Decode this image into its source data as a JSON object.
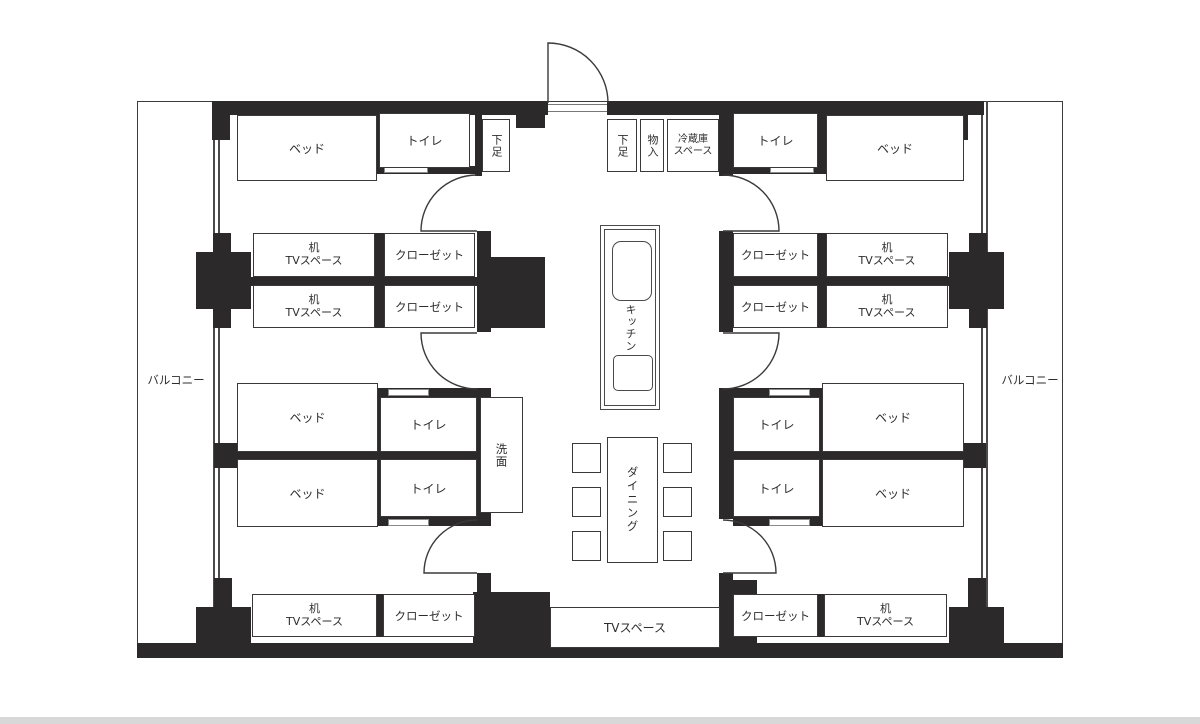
{
  "colors": {
    "wall": "#2b292a",
    "line": "#3a383a",
    "text": "#2e2d2e",
    "strip": "#d8d8d8",
    "bg": "#ffffff"
  },
  "labels": {
    "balcony": "バルコニー",
    "bed": "ベッド",
    "toilet": "トイレ",
    "closet": "クローゼット",
    "desk_line1": "机",
    "desk_line2": "TVスペース",
    "shoe": "下足",
    "storage": "物入",
    "fridge_line1": "冷蔵庫",
    "fridge_line2": "スペース",
    "kitchen": "キッチン",
    "dining": "ダイニング",
    "washstand": "洗面",
    "tv_space": "TVスペース"
  }
}
